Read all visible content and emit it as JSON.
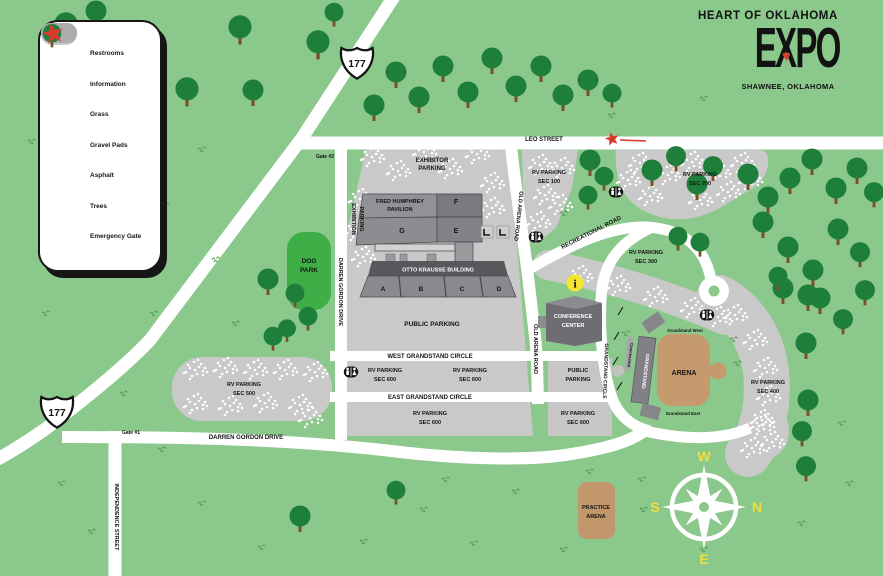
{
  "title": {
    "kicker": "HEART OF OKLAHOMA",
    "name": "EXPO",
    "heart": "♥",
    "city": "SHAWNEE, OKLAHOMA"
  },
  "legend": {
    "items": [
      {
        "icon": "restrooms-icon",
        "label": "Restrooms"
      },
      {
        "icon": "information-icon",
        "label": "Information"
      },
      {
        "icon": "grass-swatch",
        "label": "Grass"
      },
      {
        "icon": "gravel-pads-swatch",
        "label": "Gravel Pads"
      },
      {
        "icon": "asphalt-swatch",
        "label": "Asphalt"
      },
      {
        "icon": "tree-icon",
        "label": "Trees"
      },
      {
        "icon": "emergency-gate-icon",
        "label": "Emergency Gate"
      }
    ]
  },
  "highway": {
    "route": "177"
  },
  "gates": {
    "gate1": "Gate #1",
    "gate2": "Gate #2"
  },
  "roads": {
    "leo_street": "LEO STREET",
    "darren_gordon_drive": "DARREN GORDON DRIVE",
    "independence_street": "INDEPENDENCE STREET",
    "old_arena_road": "OLD ARENA ROAD",
    "recreational_road": "RECREATIONAL ROAD",
    "west_grandstand_circle": "WEST GRANDSTAND CIRCLE",
    "east_grandstand_circle": "EAST GRANDSTAND CIRCLE",
    "grandstand_circle": "GRANDSTAND CIRCLE"
  },
  "parking": {
    "exhibitor": {
      "l1": "EXHIBITOR",
      "l2": "PARKING"
    },
    "exhibition": {
      "l1": "EXHIBITION",
      "l2": "PARKING"
    },
    "public_central": "PUBLIC PARKING",
    "public_east": {
      "l1": "PUBLIC",
      "l2": "PARKING"
    },
    "sec100": {
      "l1": "RV PARKING",
      "l2": "SEC 100"
    },
    "sec200": {
      "l1": "RV PARKING",
      "l2": "SEC 200"
    },
    "sec300": {
      "l1": "RV PARKING",
      "l2": "SEC 300"
    },
    "sec400": {
      "l1": "RV PARKING",
      "l2": "SEC 400"
    },
    "sec500": {
      "l1": "RV PARKING",
      "l2": "SEC 500"
    },
    "sec600": {
      "l1": "RV PARKING",
      "l2": "SEC 600"
    }
  },
  "buildings": {
    "fred_humphrey": {
      "l1": "FRED HUMPHREY",
      "l2": "PAVILION"
    },
    "otto_krausse": "OTTO KRAUSSE BUILDING",
    "sections": {
      "a": "A",
      "b": "B",
      "c": "C",
      "d": "D",
      "e": "E",
      "f": "F",
      "g": "G"
    },
    "conference_center": {
      "l1": "CONFERENCE",
      "l2": "CENTER"
    },
    "grandstand": "GRANDSTAND",
    "concession": "Concession",
    "grandstand_west": "Grandstand West",
    "grandstand_east": "Grandstand East",
    "arena": "ARENA",
    "practice_arena": {
      "l1": "PRACTICE",
      "l2": "ARENA"
    },
    "dog_park": {
      "l1": "DOG",
      "l2": "PARK"
    }
  },
  "compass": {
    "n": "N",
    "s": "S",
    "e": "E",
    "w": "W"
  },
  "colors": {
    "background": "#8BC88B",
    "road": "#FFFFFF",
    "asphalt": "#C9C9C9",
    "building_gray": "#85858A",
    "building_dark": "#58585C",
    "arena_tan": "#C59B6D",
    "dog_park_green": "#3FAE47",
    "info_yellow": "#F6E52F",
    "emergency_red": "#D83B2B",
    "tree_green": "#1E7F3B",
    "compass_yellow": "#F2DE3C"
  }
}
